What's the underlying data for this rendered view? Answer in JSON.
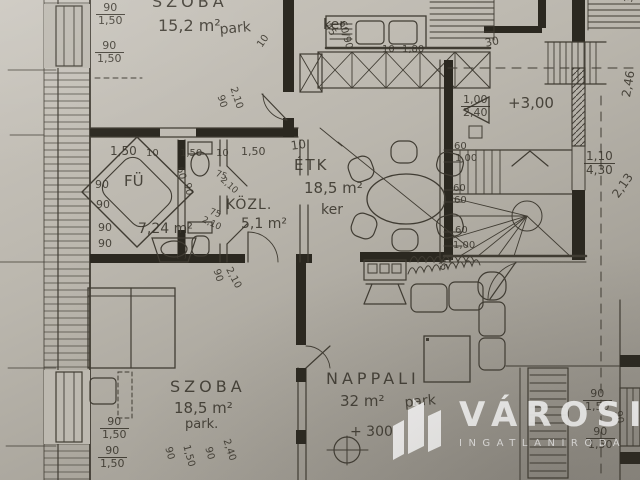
{
  "paper": {
    "background_top": "#cbc7bf",
    "background_bottom": "#918d85",
    "ink": "#403c33",
    "wall_fill": "#2b2820",
    "watermark_color": "#ffffff"
  },
  "watermark": {
    "brand": "VÁROSI",
    "subtitle": "INGATLANIRODA",
    "icon": "city-buildings-icon"
  },
  "rooms": [
    {
      "name": "SZOBA",
      "area": "15,2 m²",
      "floor": "park"
    },
    {
      "name": "FÜ",
      "area": "7,24 m²",
      "floor": ""
    },
    {
      "name": "KÖZL.",
      "area": "5,1 m²",
      "floor": ""
    },
    {
      "name": "ÉTK",
      "area": "18,5 m²",
      "floor": "ker"
    },
    {
      "name": "SZOBA",
      "area": "18,5 m²",
      "floor": "park."
    },
    {
      "name": "NAPPALI",
      "area": "32 m²",
      "floor": "park"
    }
  ],
  "levels": [
    "+3,00",
    "+ 300"
  ],
  "texts": [
    {
      "n": "room-label-szoba1",
      "t": "SZOBA",
      "x": 152,
      "y": -6,
      "s": 16,
      "sp": 4
    },
    {
      "n": "room-area-szoba1",
      "t": "15,2 m²",
      "x": 158,
      "y": 18,
      "s": 16
    },
    {
      "n": "floor-note-szoba1",
      "t": "park",
      "x": 219,
      "y": 23,
      "s": 14,
      "r": -5
    },
    {
      "n": "floor-note-kitchen",
      "t": "ker.",
      "x": 323,
      "y": 18,
      "s": 14
    },
    {
      "n": "room-label-furdo",
      "t": "FÜ",
      "x": 124,
      "y": 174,
      "s": 15
    },
    {
      "n": "room-area-furdo",
      "t": "7,24 m²",
      "x": 138,
      "y": 222,
      "s": 14
    },
    {
      "n": "room-label-kozl",
      "t": "KÖZL.",
      "x": 226,
      "y": 198,
      "s": 14,
      "sp": 1
    },
    {
      "n": "room-area-kozl",
      "t": "5,1 m²",
      "x": 241,
      "y": 217,
      "s": 14
    },
    {
      "n": "room-label-etkezo",
      "t": "ÉTK",
      "x": 294,
      "y": 158,
      "s": 15,
      "sp": 2
    },
    {
      "n": "room-area-etkezo",
      "t": "18,5 m²",
      "x": 304,
      "y": 181,
      "s": 15
    },
    {
      "n": "floor-note-etkezo",
      "t": "ker",
      "x": 321,
      "y": 203,
      "s": 14
    },
    {
      "n": "room-label-szoba2",
      "t": "SZOBA",
      "x": 170,
      "y": 379,
      "s": 16,
      "sp": 4
    },
    {
      "n": "room-area-szoba2",
      "t": "18,5 m²",
      "x": 174,
      "y": 401,
      "s": 15
    },
    {
      "n": "floor-note-szoba2",
      "t": "park.",
      "x": 185,
      "y": 418,
      "s": 13
    },
    {
      "n": "room-label-nappali",
      "t": "NAPPALI",
      "x": 326,
      "y": 371,
      "s": 16,
      "sp": 4
    },
    {
      "n": "room-area-nappali",
      "t": "32 m²",
      "x": 340,
      "y": 394,
      "s": 15
    },
    {
      "n": "floor-note-nappali",
      "t": "park",
      "x": 404,
      "y": 396,
      "s": 14,
      "r": -5
    },
    {
      "n": "level-mark-stair",
      "t": "+3,00",
      "x": 508,
      "y": 96,
      "s": 15
    },
    {
      "n": "level-mark-nappali",
      "t": "+ 300",
      "x": 350,
      "y": 425,
      "s": 14
    },
    {
      "n": "dim-window",
      "t": "90",
      "b": "1,50",
      "x": 96,
      "y": 2
    },
    {
      "n": "dim-window",
      "t": "90",
      "b": "1,50",
      "x": 95,
      "y": 40
    },
    {
      "n": "dim-door",
      "t": "90",
      "x": 224,
      "y": 94,
      "r": 72,
      "s": 10
    },
    {
      "n": "dim-door",
      "t": "2,10",
      "x": 237,
      "y": 86,
      "r": 72,
      "s": 10
    },
    {
      "n": "dim",
      "t": "10",
      "x": 256,
      "y": 44,
      "r": -55,
      "s": 10
    },
    {
      "n": "dim",
      "t": "45",
      "x": 330,
      "y": 22,
      "r": 55,
      "s": 10
    },
    {
      "n": "dim",
      "t": "60/90",
      "x": 346,
      "y": 20,
      "r": 75,
      "s": 10
    },
    {
      "n": "dim",
      "t": "10",
      "x": 382,
      "y": 45,
      "s": 10
    },
    {
      "n": "dim",
      "t": "1,80",
      "x": 402,
      "y": 45,
      "s": 10
    },
    {
      "n": "dim",
      "t": "10",
      "x": 290,
      "y": 140,
      "s": 12,
      "r": -8
    },
    {
      "n": "dim",
      "t": "1,50",
      "x": 110,
      "y": 145,
      "s": 12
    },
    {
      "n": "dim",
      "t": "10",
      "x": 146,
      "y": 149,
      "s": 10
    },
    {
      "n": "dim",
      "t": "1,50",
      "x": 180,
      "y": 149,
      "s": 10
    },
    {
      "n": "dim",
      "t": "10",
      "x": 216,
      "y": 149,
      "s": 10
    },
    {
      "n": "dim",
      "t": "1,50",
      "x": 241,
      "y": 146,
      "s": 11
    },
    {
      "n": "dim-wc",
      "t": "60",
      "x": 184,
      "y": 166,
      "r": 78,
      "s": 10
    },
    {
      "n": "dim-wc",
      "t": "90",
      "x": 191,
      "y": 182,
      "r": 78,
      "s": 10
    },
    {
      "n": "dim",
      "t": "90",
      "x": 95,
      "y": 179,
      "s": 11
    },
    {
      "n": "dim",
      "t": "90",
      "x": 96,
      "y": 199,
      "s": 11
    },
    {
      "n": "dim",
      "t": "90",
      "x": 98,
      "y": 222,
      "s": 11
    },
    {
      "n": "dim",
      "t": "90",
      "x": 98,
      "y": 238,
      "s": 11
    },
    {
      "n": "dim-door",
      "t": "75",
      "x": 217,
      "y": 170,
      "s": 9,
      "r": 20
    },
    {
      "n": "dim-door",
      "t": "2,10",
      "x": 224,
      "y": 176,
      "s": 9,
      "r": 42
    },
    {
      "n": "dim-door",
      "t": "75",
      "x": 211,
      "y": 208,
      "s": 9,
      "r": 20
    },
    {
      "n": "dim-door",
      "t": "2,10",
      "x": 204,
      "y": 216,
      "s": 9,
      "r": 25
    },
    {
      "n": "dim-door",
      "t": "90",
      "x": 220,
      "y": 268,
      "r": 72,
      "s": 10
    },
    {
      "n": "dim-door",
      "t": "2,10",
      "x": 232,
      "y": 266,
      "r": 62,
      "s": 10
    },
    {
      "n": "dim-stair",
      "t": "60",
      "x": 454,
      "y": 142,
      "s": 10
    },
    {
      "n": "dim-stair",
      "t": "1,00",
      "x": 455,
      "y": 154,
      "s": 10
    },
    {
      "n": "dim-stair",
      "t": "60",
      "x": 453,
      "y": 184,
      "s": 10
    },
    {
      "n": "dim-stair",
      "t": "60",
      "x": 454,
      "y": 196,
      "s": 10
    },
    {
      "n": "dim-stair",
      "t": "60",
      "x": 455,
      "y": 226,
      "s": 10
    },
    {
      "n": "dim-stair",
      "t": "1,00",
      "x": 453,
      "y": 241,
      "s": 10
    },
    {
      "n": "dim-stair",
      "t": "45",
      "x": 444,
      "y": 257,
      "r": 70,
      "s": 10
    },
    {
      "n": "dim",
      "t": "1,00",
      "b": "2,40",
      "x": 461,
      "y": 94,
      "s": 11
    },
    {
      "n": "dim",
      "t": "30",
      "x": 484,
      "y": 38,
      "s": 11,
      "r": -12
    },
    {
      "n": "dim",
      "t": "1,10",
      "b": "4,30",
      "x": 584,
      "y": 150,
      "s": 12
    },
    {
      "n": "dim",
      "t": "2,46",
      "x": 620,
      "y": 96,
      "r": -80,
      "s": 12
    },
    {
      "n": "dim",
      "t": "2,13",
      "x": 610,
      "y": 193,
      "r": -55,
      "s": 12
    },
    {
      "n": "dim",
      "t": "3,55",
      "x": 623,
      "y": 2,
      "r": -85,
      "s": 11
    },
    {
      "n": "dim",
      "t": "90",
      "x": 172,
      "y": 446,
      "r": 75,
      "s": 10
    },
    {
      "n": "dim",
      "t": "1,50",
      "x": 190,
      "y": 444,
      "r": 75,
      "s": 10
    },
    {
      "n": "dim",
      "t": "90",
      "x": 212,
      "y": 446,
      "r": 75,
      "s": 10
    },
    {
      "n": "dim",
      "t": "2,40",
      "x": 230,
      "y": 438,
      "r": 72,
      "s": 10
    },
    {
      "n": "dim-window",
      "t": "90",
      "b": "1,50",
      "x": 100,
      "y": 416
    },
    {
      "n": "dim-window",
      "t": "90",
      "b": "1,50",
      "x": 98,
      "y": 445
    },
    {
      "n": "dim-window",
      "t": "90",
      "b": "1,50",
      "x": 583,
      "y": 388
    },
    {
      "n": "dim-window",
      "t": "90",
      "b": "1,50",
      "x": 586,
      "y": 426
    },
    {
      "n": "dim",
      "t": "90",
      "x": 622,
      "y": 410,
      "r": 80,
      "s": 10
    }
  ]
}
